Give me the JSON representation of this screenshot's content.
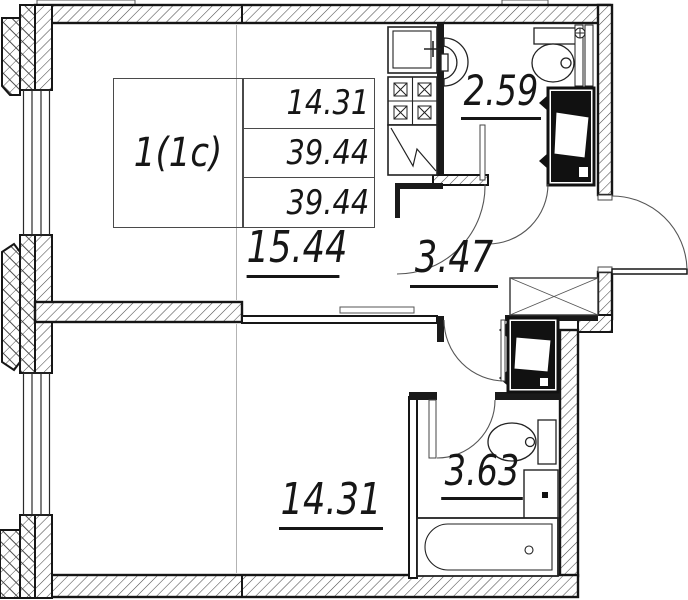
{
  "plan": {
    "apartment_label": "1(1c)",
    "info_table": {
      "values": [
        "14.31",
        "39.44",
        "39.44"
      ]
    },
    "areas": {
      "living_kitchen": "15.44",
      "bathroom_top": "2.59",
      "hallway": "3.47",
      "bedroom": "14.31",
      "bathroom_bottom": "3.63"
    },
    "fixtures": [
      "kitchen-sink",
      "stove",
      "refrigerator",
      "wash-basin",
      "toilet",
      "ventilation-shaft",
      "wardrobe",
      "bathtub",
      "entrance-door",
      "window"
    ],
    "colors": {
      "line": "#161616",
      "background": "#ffffff",
      "axis": "#b3b3b3"
    }
  }
}
